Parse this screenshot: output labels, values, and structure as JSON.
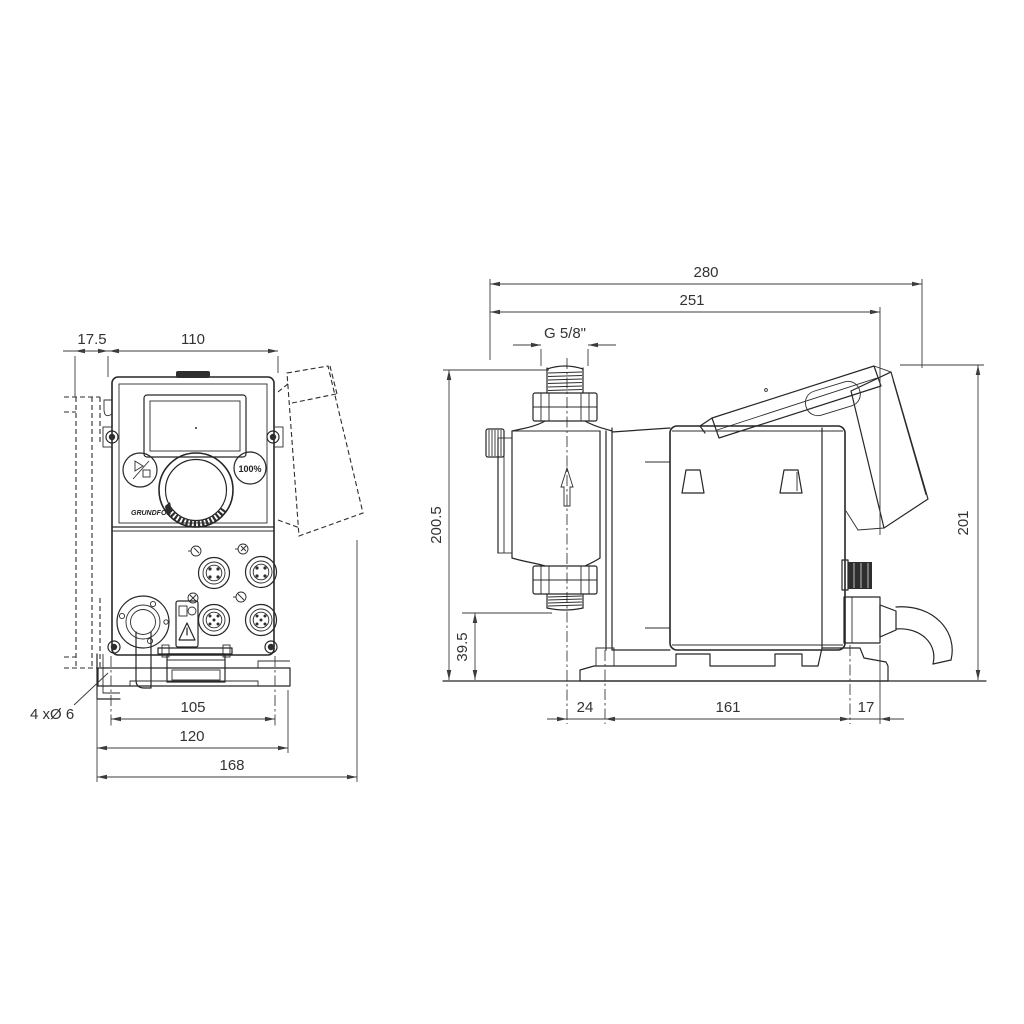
{
  "colors": {
    "line": "#262626",
    "dim_line": "#3c3c3c",
    "dim_text": "#333333",
    "background": "#ffffff",
    "dark_fill": "#2e2e2e"
  },
  "front_view": {
    "title": "front-view",
    "logo_text": "GRUNDFOS",
    "capacity_button_label": "100%",
    "dimensions": {
      "bracket_offset": "17.5",
      "width": "110",
      "mounting_hole_note": "4 xØ 6",
      "hole_spacing": "105",
      "plate_width": "120",
      "overall_width": "168"
    }
  },
  "side_view": {
    "title": "side-view",
    "dimensions": {
      "overall_depth": "280",
      "depth_to_cover": "251",
      "connection_thread": "G 5/8\"",
      "inlet_height": "200.5",
      "outlet_height": "39.5",
      "head_overhang": "24",
      "foot_length": "161",
      "rear_overhang": "17",
      "overall_height": "201"
    }
  }
}
